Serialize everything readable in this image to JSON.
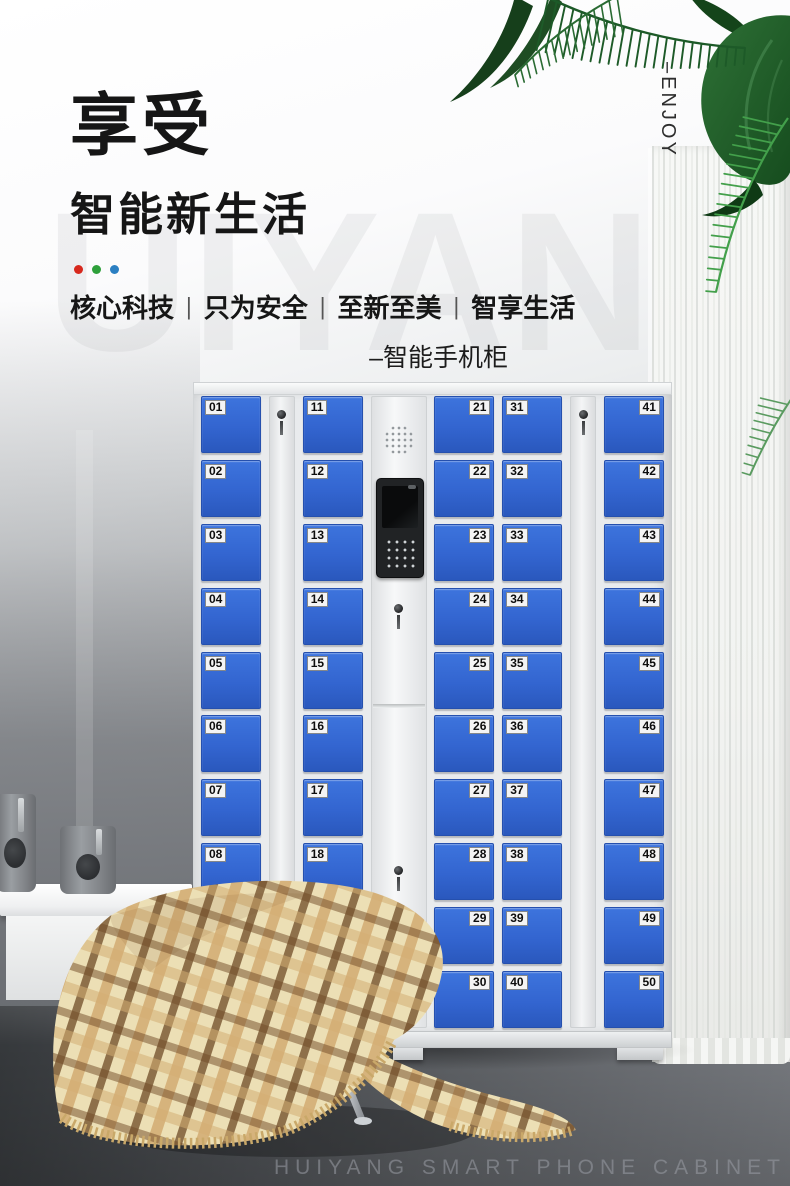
{
  "brand": {
    "bg_watermark": "UIYAN",
    "vertical_tag": "–ENJOY",
    "footer_watermark": "HUIYANG SMART PHONE CABINET"
  },
  "hero": {
    "title": "享受",
    "subtitle": "智能新生活",
    "dot_colors": [
      "#d7281d",
      "#2ea03b",
      "#2b7fc2"
    ],
    "tagline": [
      "核心科技",
      "只为安全",
      "至新至美",
      "智享生活"
    ],
    "separator": "|",
    "product_label": "–智能手机柜"
  },
  "cabinet": {
    "lockers_total": 50,
    "door_color": "#3365d0",
    "body_color": "#e9ebed",
    "columns": [
      {
        "id": "doors-01-10",
        "type": "doors",
        "label_side": "left",
        "numbers": [
          "01",
          "02",
          "03",
          "04",
          "05",
          "06",
          "07",
          "08",
          "09",
          "10"
        ]
      },
      {
        "id": "lock-strip-left",
        "type": "lock-strip"
      },
      {
        "id": "doors-11-20",
        "type": "doors",
        "label_side": "left",
        "numbers": [
          "11",
          "12",
          "13",
          "14",
          "15",
          "16",
          "17",
          "18",
          "19",
          "20"
        ]
      },
      {
        "id": "control-console",
        "type": "console"
      },
      {
        "id": "doors-21-30",
        "type": "doors",
        "label_side": "right",
        "numbers": [
          "21",
          "22",
          "23",
          "24",
          "25",
          "26",
          "27",
          "28",
          "29",
          "30"
        ]
      },
      {
        "id": "doors-31-40",
        "type": "doors",
        "label_side": "left",
        "numbers": [
          "31",
          "32",
          "33",
          "34",
          "35",
          "36",
          "37",
          "38",
          "39",
          "40"
        ]
      },
      {
        "id": "lock-strip-right",
        "type": "lock-strip"
      },
      {
        "id": "doors-41-50",
        "type": "doors",
        "label_side": "right",
        "numbers": [
          "41",
          "42",
          "43",
          "44",
          "45",
          "46",
          "47",
          "48",
          "49",
          "50"
        ]
      }
    ]
  }
}
